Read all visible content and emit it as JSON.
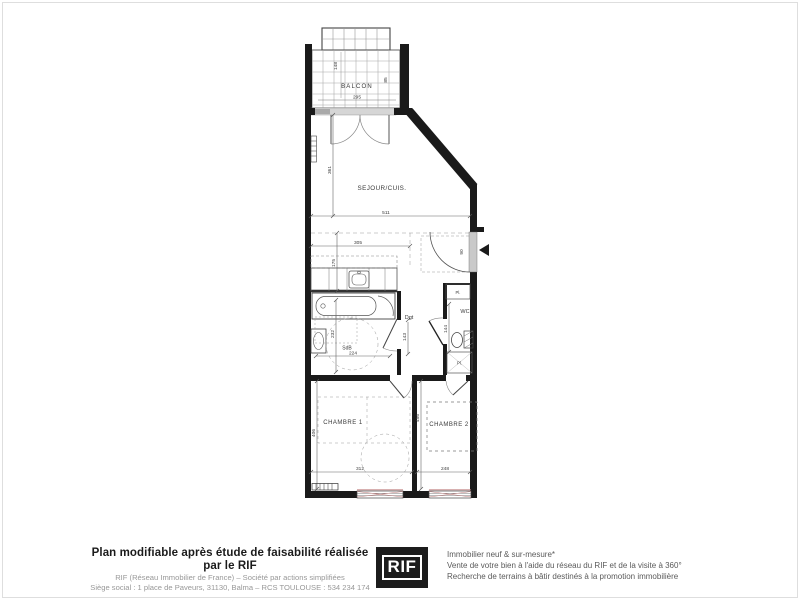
{
  "colors": {
    "wall": "#1a1a1a",
    "line": "#555555",
    "dim_text": "#444444",
    "window_accent": "#c08080",
    "logo_bg": "#1c1c1c",
    "logo_text": "#ffffff"
  },
  "floorplan": {
    "labels": {
      "balcon": "BALCON",
      "sejour": "SEJOUR/CUIS.",
      "sdb": "SdB",
      "dgt": "Dgt",
      "wc": "WC",
      "placard": "Pl.",
      "chambre1": "CHAMBRE 1",
      "chambre2": "CHAMBRE 2"
    },
    "dimensions": {
      "balcon_width": "295",
      "balcon_depth": "148",
      "balcon_side": "85",
      "sejour_height": "361",
      "sejour_width": "511",
      "cuisine_width": "305",
      "cuisine_depth": "175",
      "sdb_width": "224",
      "sdb_height": "232",
      "dgt_height": "143",
      "wc_height": "144",
      "entree_door": "90",
      "chambre1_height": "406",
      "chambre1_width": "312",
      "chambre2_height": "456",
      "chambre2_width": "248"
    }
  },
  "footer": {
    "left": {
      "title": "Plan modifiable après étude de faisabilité réalisée par le RIF",
      "line2": "RIF (Réseau Immobilier de France) – Société par actions simplifiées",
      "line3": "Siège social : 1 place de Paveurs, 31130, Balma – RCS TOULOUSE : 534 234 174"
    },
    "logo": {
      "text": "RIF"
    },
    "right": {
      "line1": "Immobilier neuf & sur-mesure*",
      "line2": "Vente de votre bien à l'aide du réseau du RIF et de la visite à 360°",
      "line3": "Recherche de terrains à bâtir destinés à la promotion immobilière"
    }
  }
}
